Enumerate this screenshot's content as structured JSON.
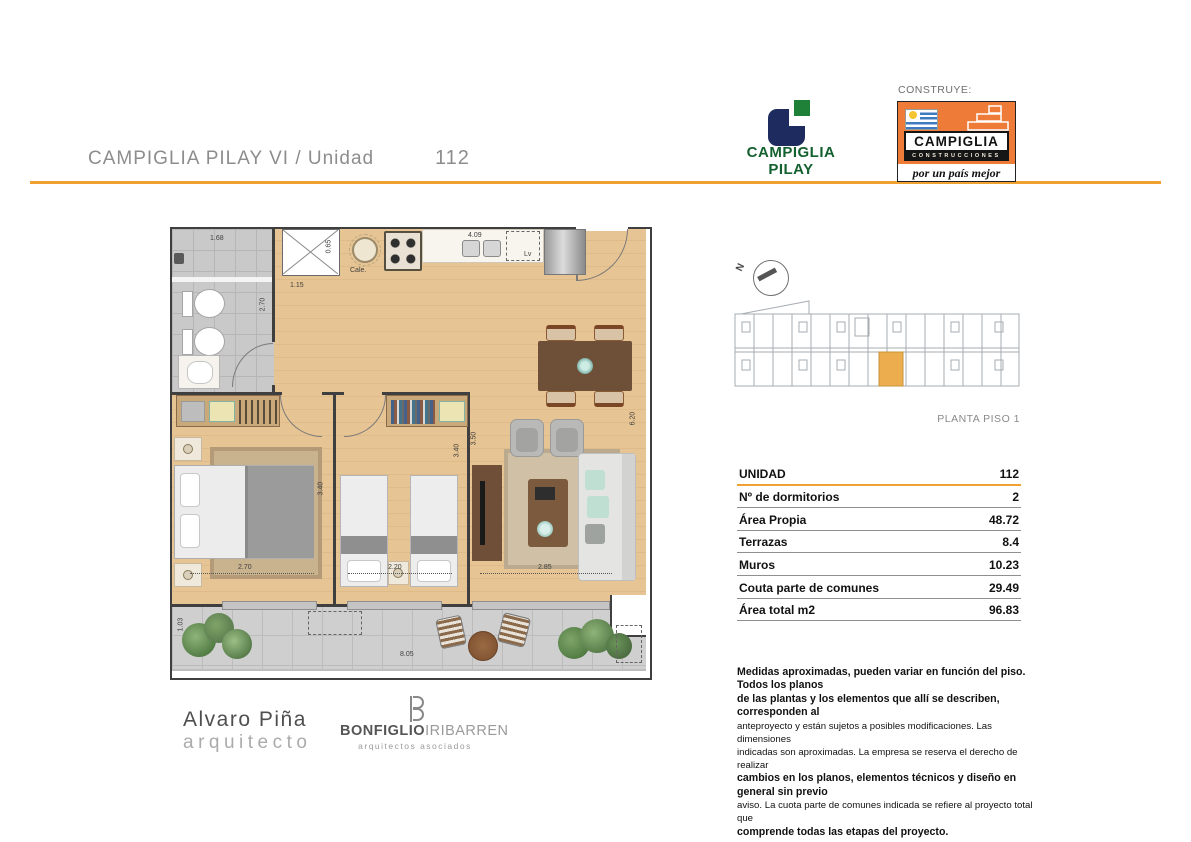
{
  "header": {
    "title": "CAMPIGLIA PILAY VI  /  Unidad",
    "unit_number": "112",
    "rule_color": "#F1A12F"
  },
  "logos": {
    "pilay": {
      "line1": "CAMPIGLIA",
      "line2": "PILAY",
      "navy": "#1E2B5E",
      "green": "#1F8138"
    },
    "construye_label": "CONSTRUYE:",
    "construcciones": {
      "name": "CAMPIGLIA",
      "subtitle": "CONSTRUCCIONES",
      "tagline": "por un país mejor",
      "orange": "#EE7C38"
    }
  },
  "keyplan": {
    "label": "PLANTA PISO 1",
    "north": "N",
    "highlight_color": "#EBAD4E"
  },
  "table": {
    "rows": [
      {
        "label": "UNIDAD",
        "value": "112"
      },
      {
        "label": "Nº de dormitorios",
        "value": "2"
      },
      {
        "label": "Área Propia",
        "value": "48.72"
      },
      {
        "label": "Terrazas",
        "value": "8.4"
      },
      {
        "label": "Muros",
        "value": "10.23"
      },
      {
        "label": "Couta parte de comunes",
        "value": "29.49"
      },
      {
        "label": "Área total m2",
        "value": "96.83"
      }
    ]
  },
  "disclaimer": {
    "lines": [
      {
        "t": "Medidas aproximadas, pueden variar en función del piso. Todos los planos",
        "s": "b"
      },
      {
        "t": "de las plantas y los elementos que allí se describen, corresponden al",
        "s": "b"
      },
      {
        "t": "anteproyecto y están sujetos a posibles modificaciones. Las dimensiones",
        "s": "n"
      },
      {
        "t": "indicadas son aproximadas. La empresa se reserva el derecho de realizar",
        "s": "n"
      },
      {
        "t": "cambios en los planos, elementos técnicos y diseño en general sin previo",
        "s": "b"
      },
      {
        "t": "aviso. La cuota parte de comunes indicada se refiere al proyecto total que",
        "s": "n"
      },
      {
        "t": "comprende todas las etapas del proyecto.",
        "s": "b"
      }
    ]
  },
  "architects": {
    "name": "Alvaro Piña",
    "role": "arquitecto",
    "firm_bold": "BONFIGLIO",
    "firm_light": "IRIBARREN",
    "firm_sub": "arquitectos asociados"
  },
  "floorplan": {
    "labels": {
      "heater": "Cale.",
      "laundry": "Lv"
    },
    "dims": {
      "bath_width": "1.68",
      "bath_depth": "2.70",
      "shaft": "0.65",
      "hall": "1.15",
      "kitchen_counter": "4.09",
      "living_depth": "6.20",
      "living_inner": "3.50",
      "bed1_depth": "3.40",
      "bed2_depth": "3.40",
      "bed1_width": "2.70",
      "bed2_width": "2.20",
      "living_width": "2.85",
      "terrace_width": "8.05",
      "terrace_depth": "1.03"
    }
  }
}
